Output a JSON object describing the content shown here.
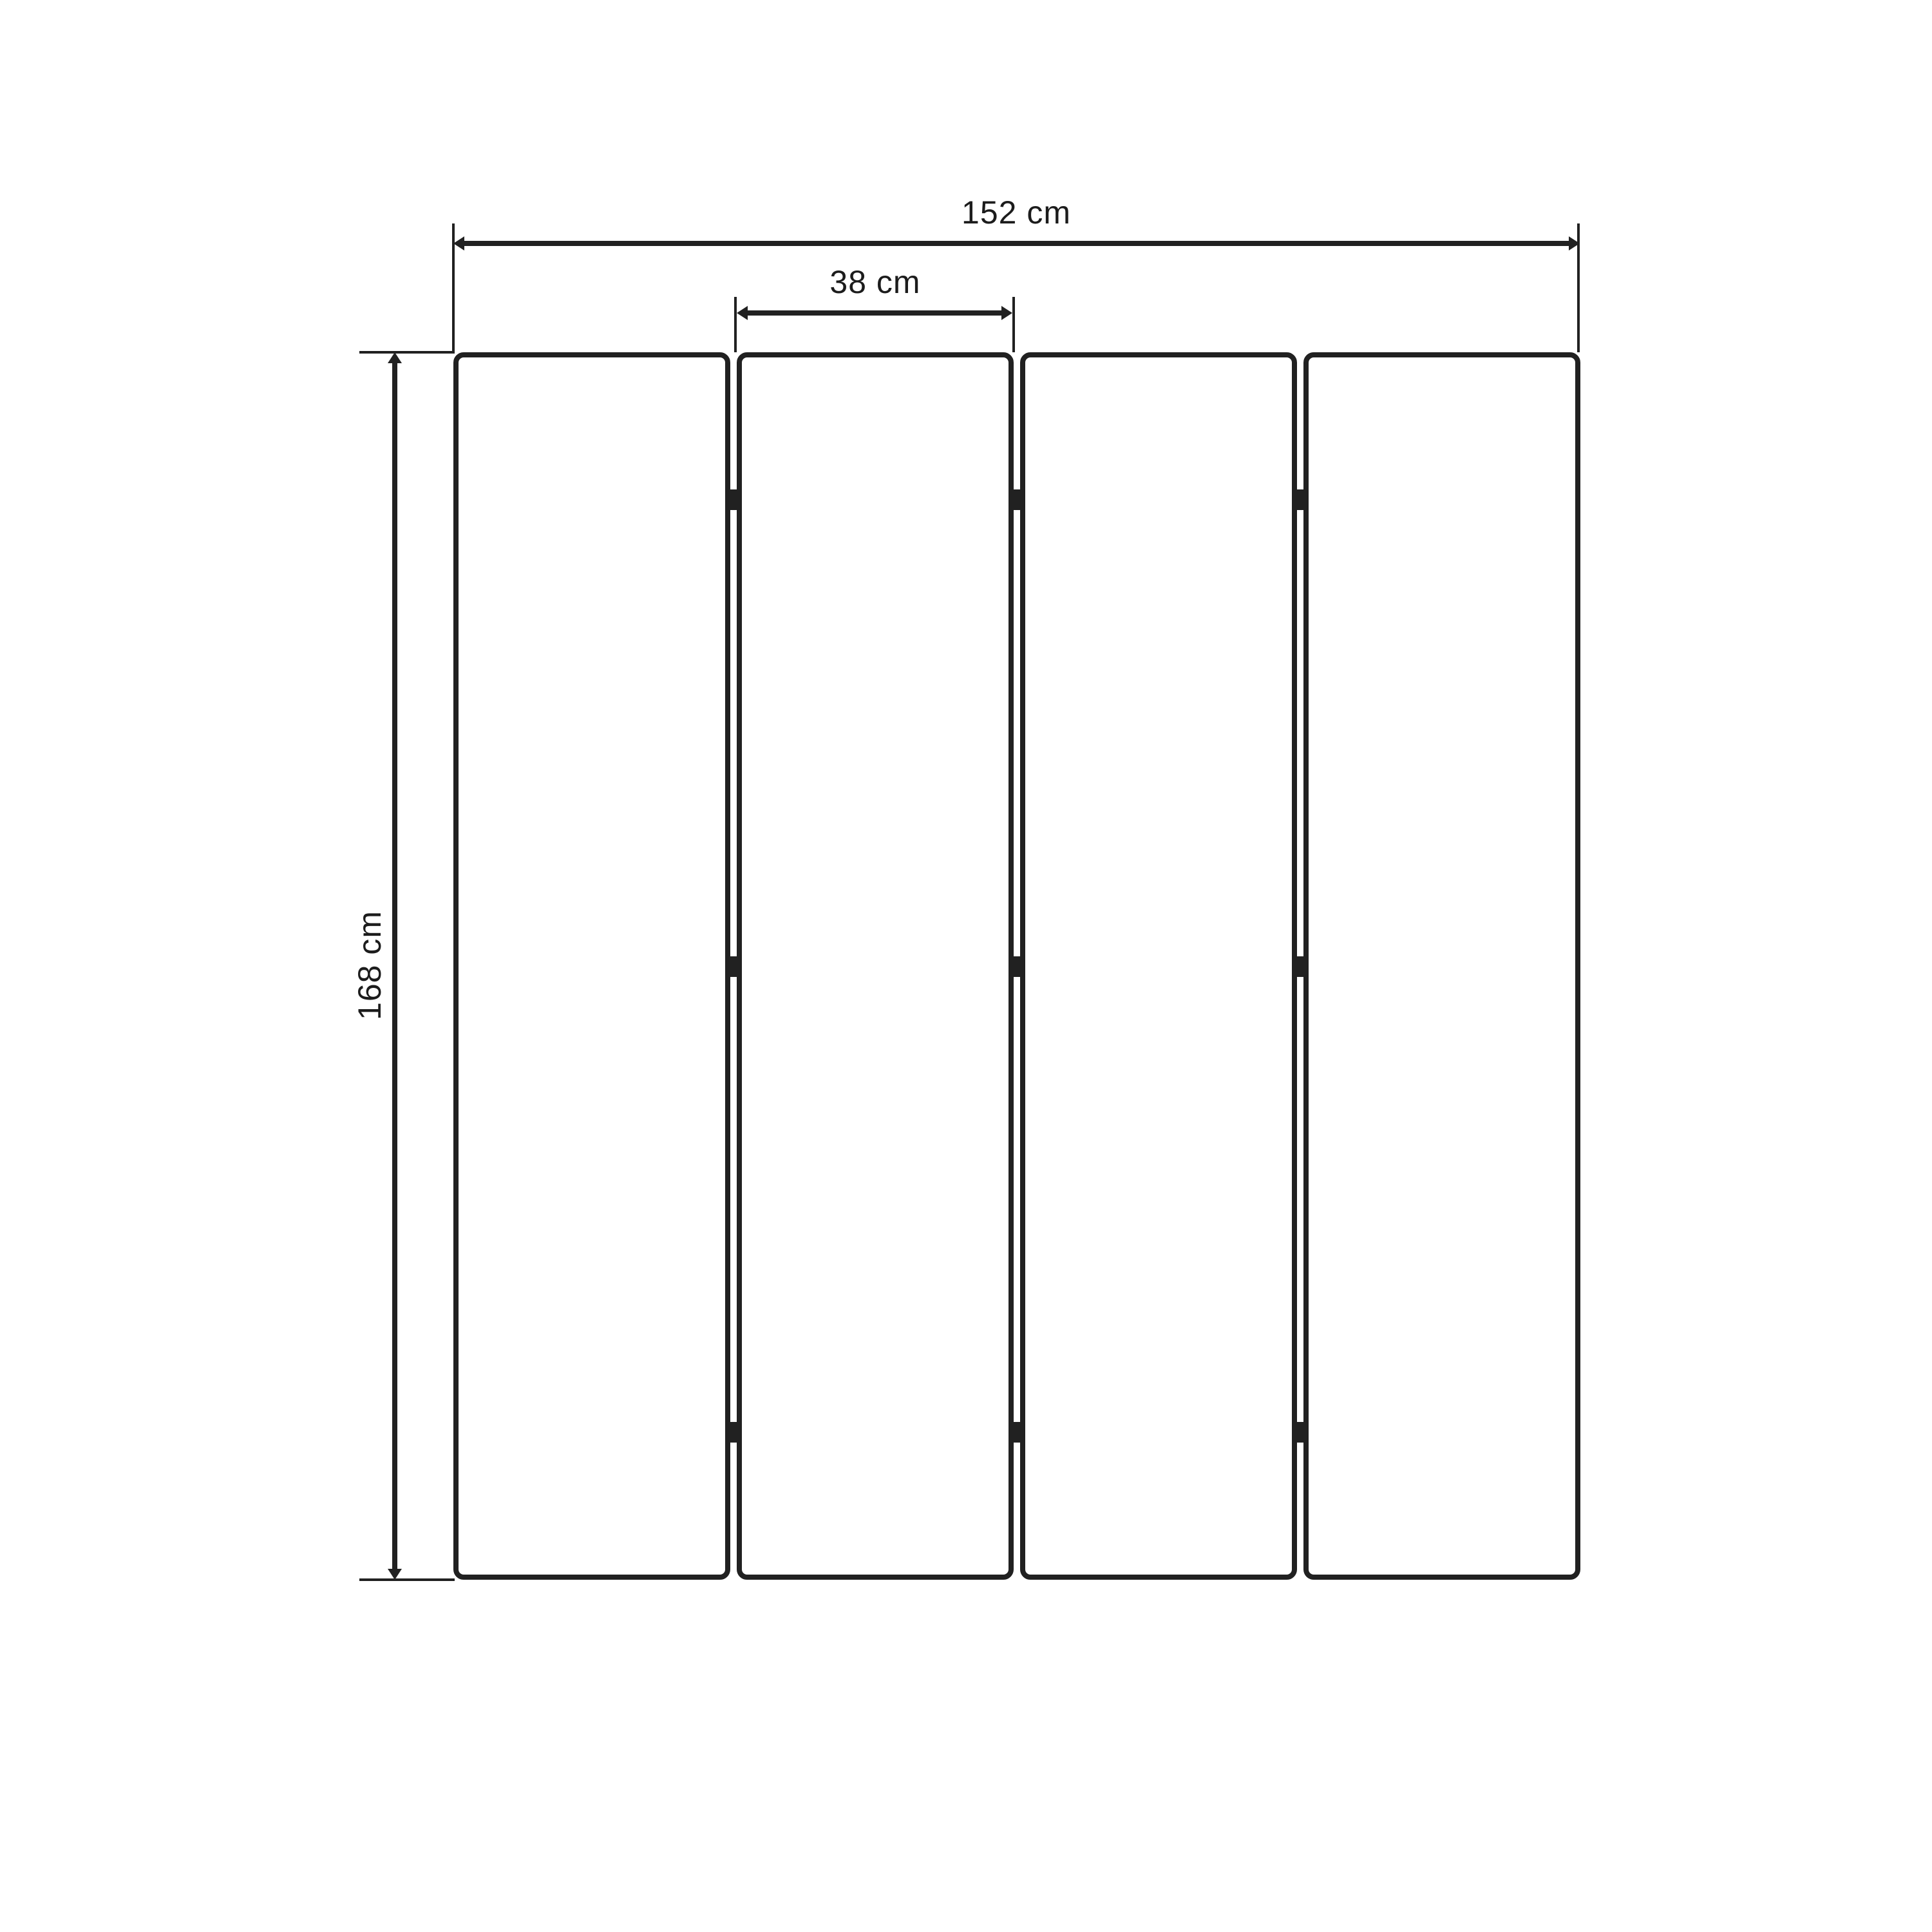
{
  "diagram": {
    "type": "dimension-drawing",
    "subject": "four-panel folding screen, front elevation",
    "panel_count": 4,
    "hinge_rows": 3,
    "colors": {
      "line": "#212121",
      "background": "#ffffff"
    },
    "labels": {
      "total_width": "152 cm",
      "panel_width": "38 cm",
      "height": "168 cm"
    }
  }
}
